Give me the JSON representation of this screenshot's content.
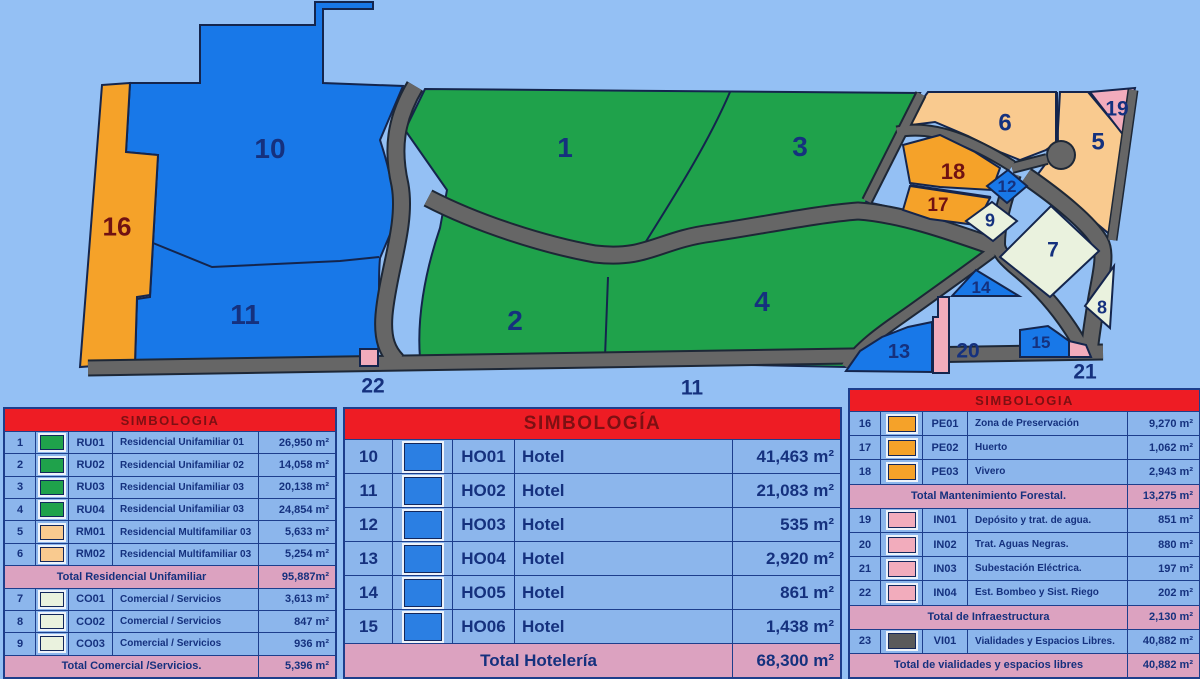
{
  "colors": {
    "page_background": "#94C0F4",
    "road": "#666666",
    "header_red": "#EE1C24",
    "header_text": "#7D1013",
    "table_row_blue": "#8CB6EC",
    "table_total_pink": "#DCA2C0",
    "table_text_navy": "#15317E",
    "map_label_navy": "#15317E",
    "map_label_maroon": "#701112",
    "swatches": {
      "green": "#1FA24B",
      "peach": "#F9CA8F",
      "pale": "#EAF2DE",
      "blue": "#2B7FE3",
      "orange": "#F5A229",
      "pink": "#F2ACBC",
      "gray": "#5A5A5A"
    }
  },
  "map": {
    "labels": [
      {
        "id": "p1",
        "text": "1",
        "tone": "navy"
      },
      {
        "id": "p2",
        "text": "2",
        "tone": "navy"
      },
      {
        "id": "p3",
        "text": "3",
        "tone": "navy"
      },
      {
        "id": "p4",
        "text": "4",
        "tone": "navy"
      },
      {
        "id": "p10",
        "text": "10",
        "tone": "navy"
      },
      {
        "id": "p11",
        "text": "11",
        "tone": "navy"
      },
      {
        "id": "p16",
        "text": "16",
        "tone": "maroon"
      },
      {
        "id": "p5",
        "text": "5",
        "tone": "navy"
      },
      {
        "id": "p6",
        "text": "6",
        "tone": "navy"
      },
      {
        "id": "p19",
        "text": "19",
        "tone": "navy"
      },
      {
        "id": "p18",
        "text": "18",
        "tone": "maroon"
      },
      {
        "id": "p17",
        "text": "17",
        "tone": "maroon"
      },
      {
        "id": "p12",
        "text": "12",
        "tone": "navy"
      },
      {
        "id": "p9",
        "text": "9",
        "tone": "navy"
      },
      {
        "id": "p7",
        "text": "7",
        "tone": "navy"
      },
      {
        "id": "p8",
        "text": "8",
        "tone": "navy"
      },
      {
        "id": "p14",
        "text": "14",
        "tone": "navy"
      },
      {
        "id": "p13",
        "text": "13",
        "tone": "navy"
      },
      {
        "id": "p20",
        "text": "20",
        "tone": "navy"
      },
      {
        "id": "p15",
        "text": "15",
        "tone": "navy"
      },
      {
        "id": "p21",
        "text": "21",
        "tone": "navy"
      },
      {
        "id": "p22",
        "text": "22",
        "tone": "navy"
      },
      {
        "id": "p11b",
        "text": "11",
        "tone": "navy"
      }
    ]
  },
  "tables": {
    "left": {
      "title": "SIMBOLOGIA",
      "rows": [
        {
          "type": "item",
          "num": "1",
          "color": "green",
          "code": "RU01",
          "desc": "Residencial Unifamiliar 01",
          "area": "26,950 m²"
        },
        {
          "type": "item",
          "num": "2",
          "color": "green",
          "code": "RU02",
          "desc": "Residencial Unifamiliar 02",
          "area": "14,058 m²"
        },
        {
          "type": "item",
          "num": "3",
          "color": "green",
          "code": "RU03",
          "desc": "Residencial Unifamiliar 03",
          "area": "20,138 m²"
        },
        {
          "type": "item",
          "num": "4",
          "color": "green",
          "code": "RU04",
          "desc": "Residencial Unifamiliar 03",
          "area": "24,854 m²"
        },
        {
          "type": "item",
          "num": "5",
          "color": "peach",
          "code": "RM01",
          "desc": "Residencial Multifamiliar 03",
          "area": "5,633 m²"
        },
        {
          "type": "item",
          "num": "6",
          "color": "peach",
          "code": "RM02",
          "desc": "Residencial Multifamiliar 03",
          "area": "5,254 m²"
        },
        {
          "type": "total",
          "label": "Total Residencial Unifamiliar",
          "area": "95,887m²"
        },
        {
          "type": "item",
          "num": "7",
          "color": "pale",
          "code": "CO01",
          "desc": "Comercial / Servicios",
          "area": "3,613 m²"
        },
        {
          "type": "item",
          "num": "8",
          "color": "pale",
          "code": "CO02",
          "desc": "Comercial / Servicios",
          "area": "847 m²"
        },
        {
          "type": "item",
          "num": "9",
          "color": "pale",
          "code": "CO03",
          "desc": "Comercial / Servicios",
          "area": "936 m²"
        },
        {
          "type": "total",
          "label": "Total Comercial /Servicios.",
          "area": "5,396 m²"
        }
      ]
    },
    "middle": {
      "title": "SIMBOLOGÍA",
      "rows": [
        {
          "type": "item",
          "num": "10",
          "color": "blue",
          "code": "HO01",
          "desc": "Hotel",
          "area": "41,463 m²"
        },
        {
          "type": "item",
          "num": "11",
          "color": "blue",
          "code": "HO02",
          "desc": "Hotel",
          "area": "21,083 m²"
        },
        {
          "type": "item",
          "num": "12",
          "color": "blue",
          "code": "HO03",
          "desc": "Hotel",
          "area": "535 m²"
        },
        {
          "type": "item",
          "num": "13",
          "color": "blue",
          "code": "HO04",
          "desc": "Hotel",
          "area": "2,920 m²"
        },
        {
          "type": "item",
          "num": "14",
          "color": "blue",
          "code": "HO05",
          "desc": "Hotel",
          "area": "861 m²"
        },
        {
          "type": "item",
          "num": "15",
          "color": "blue",
          "code": "HO06",
          "desc": "Hotel",
          "area": "1,438 m²"
        },
        {
          "type": "total",
          "label": "Total Hotelería",
          "area": "68,300 m²"
        }
      ]
    },
    "right": {
      "title": "SIMBOLOGIA",
      "rows": [
        {
          "type": "item",
          "num": "16",
          "color": "orange",
          "code": "PE01",
          "desc": "Zona de Preservación",
          "area": "9,270 m²"
        },
        {
          "type": "item",
          "num": "17",
          "color": "orange",
          "code": "PE02",
          "desc": "Huerto",
          "area": "1,062 m²"
        },
        {
          "type": "item",
          "num": "18",
          "color": "orange",
          "code": "PE03",
          "desc": "Vivero",
          "area": "2,943 m²"
        },
        {
          "type": "total",
          "label": "Total Mantenimiento Forestal.",
          "area": "13,275 m²"
        },
        {
          "type": "item",
          "num": "19",
          "color": "pink",
          "code": "IN01",
          "desc": "Depósito y trat. de agua.",
          "area": "851 m²"
        },
        {
          "type": "item",
          "num": "20",
          "color": "pink",
          "code": "IN02",
          "desc": "Trat. Aguas Negras.",
          "area": "880 m²"
        },
        {
          "type": "item",
          "num": "21",
          "color": "pink",
          "code": "IN03",
          "desc": "Subestación Eléctrica.",
          "area": "197 m²"
        },
        {
          "type": "item",
          "num": "22",
          "color": "pink",
          "code": "IN04",
          "desc": "Est. Bombeo y Sist. Riego",
          "area": "202 m²"
        },
        {
          "type": "total",
          "label": "Total de Infraestructura",
          "area": "2,130 m²"
        },
        {
          "type": "item",
          "num": "23",
          "color": "gray",
          "code": "VI01",
          "desc": "Vialidades y Espacios Libres.",
          "area": "40,882 m²"
        },
        {
          "type": "total",
          "label": "Total de vialidades y espacios libres",
          "area": "40,882 m²"
        }
      ]
    }
  }
}
